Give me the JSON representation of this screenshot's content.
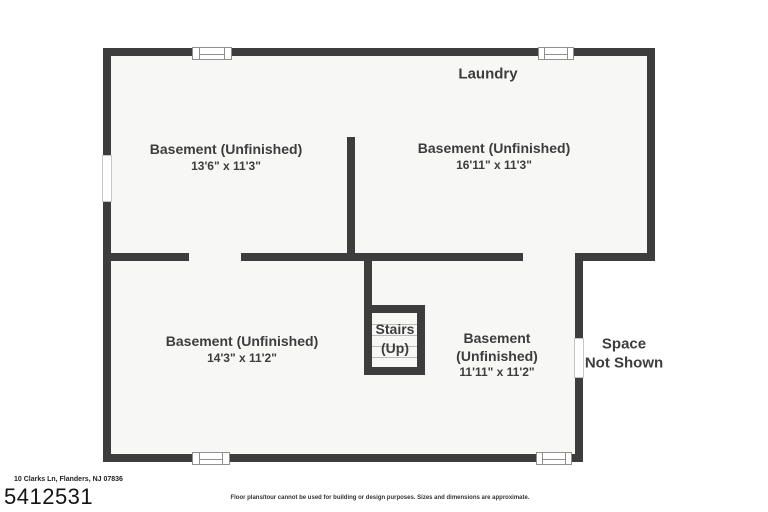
{
  "plan": {
    "laundry_label": "Laundry",
    "rooms": [
      {
        "name": "Basement (Unfinished)",
        "dims": "13'6\" x 11'3\""
      },
      {
        "name": "Basement (Unfinished)",
        "dims": "16'11\" x 11'3\""
      },
      {
        "name": "Basement (Unfinished)",
        "dims": "14'3\" x 11'2\""
      },
      {
        "name": "Basement (Unfinished)",
        "dims": "11'11\" x 11'2\""
      }
    ],
    "stairs": {
      "line1": "Stairs",
      "line2": "(Up)"
    },
    "space_not_shown": {
      "line1": "Space",
      "line2": "Not Shown"
    }
  },
  "footer": {
    "address": "10 Clarks Ln, Flanders, NJ 07836",
    "mls_id": "5412531",
    "disclaimer": "Floor plans/tour cannot be used for building or design purposes. Sizes and dimensions are approximate."
  },
  "colors": {
    "wall": "#3d3d3d",
    "floor": "#f7f7f6",
    "label_text": "#3d3d3d",
    "background": "#ffffff"
  }
}
